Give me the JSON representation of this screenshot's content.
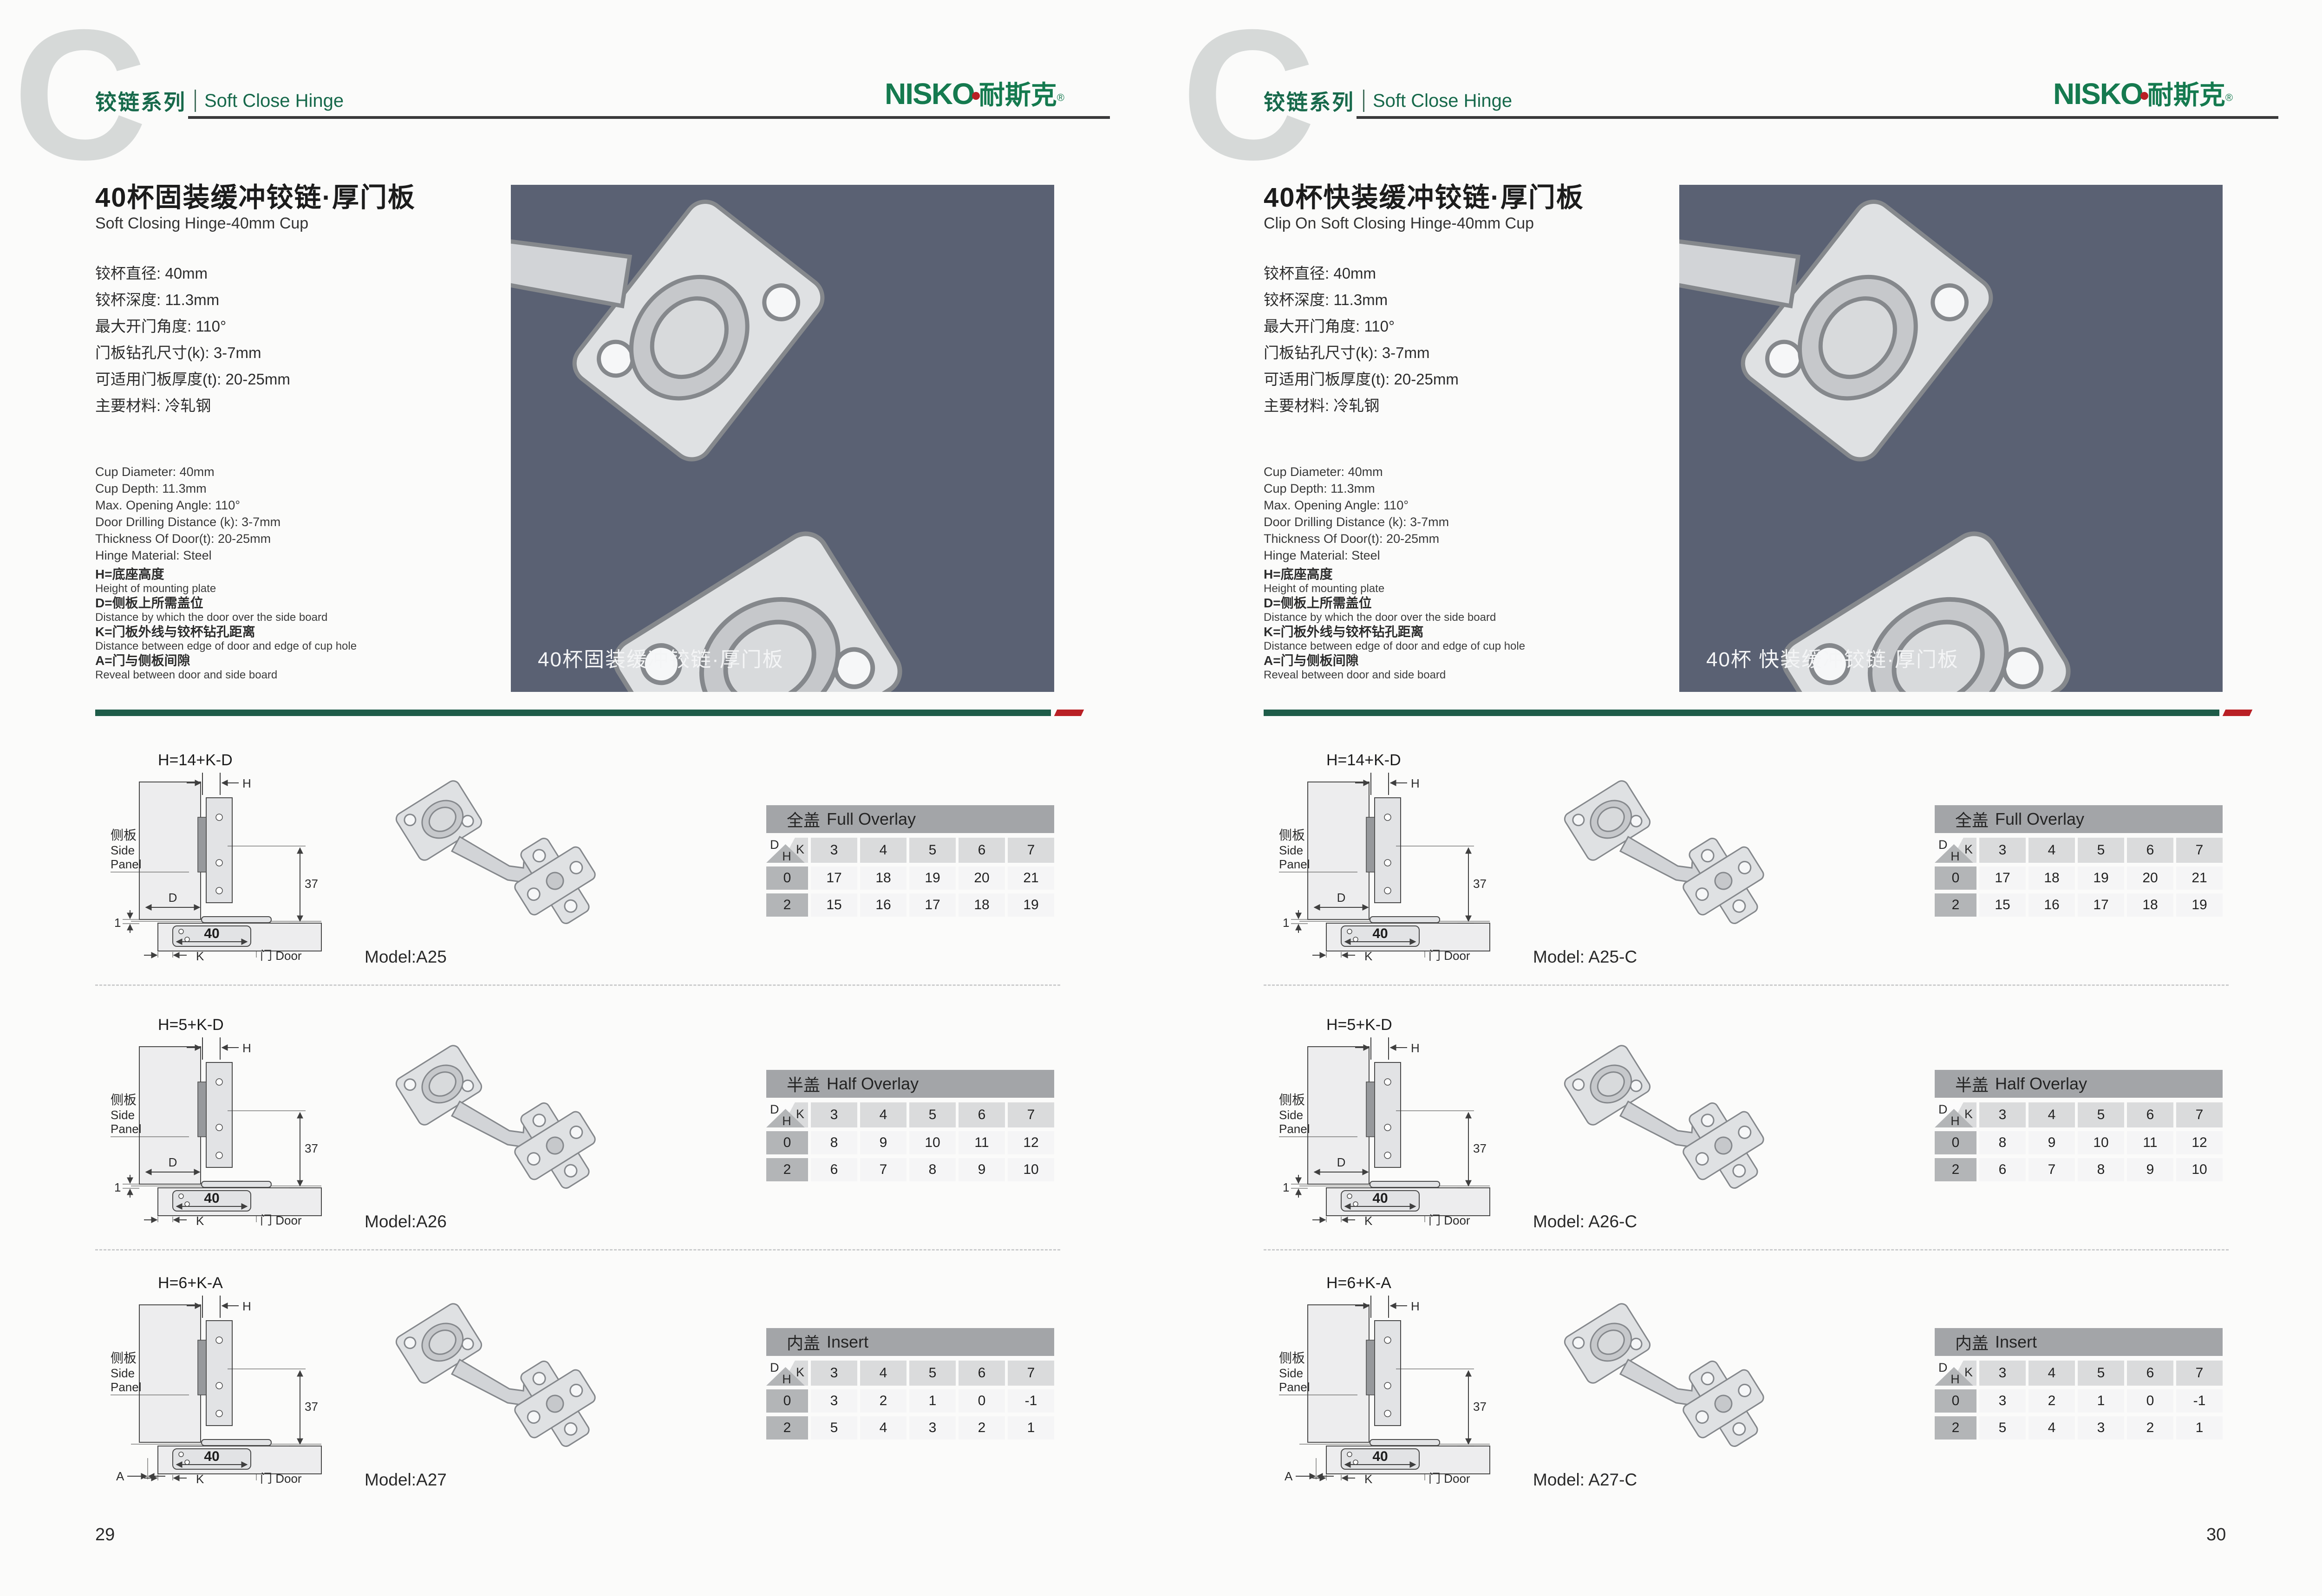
{
  "colors": {
    "accent_green": "#17694b",
    "logo_green": "#157a4f",
    "accent_red": "#b92025",
    "photo_bg": "#5a6173",
    "table_title_bg": "#a3a5a8",
    "column_header_bg": "#dadbdc",
    "row_header_bg": "#b3b5b7",
    "cell_bg": "#f5f5f6",
    "header_rule": "#3a3a3b",
    "divider_green": "#1e5c49"
  },
  "header": {
    "c_mark": "C",
    "series_cn": "铰链系列",
    "series_en": "Soft Close Hinge"
  },
  "brand": {
    "en": "NISKO",
    "cn": "耐斯克",
    "reg": "®"
  },
  "shared": {
    "specs_cn": [
      "铰杯直径: 40mm",
      "铰杯深度: 11.3mm",
      "最大开门角度: 110°",
      "门板钻孔尺寸(k): 3-7mm",
      "可适用门板厚度(t): 20-25mm",
      "主要材料: 冷轧钢"
    ],
    "specs_en": [
      "Cup Diameter: 40mm",
      "Cup Depth: 11.3mm",
      "Max. Opening Angle: 110°",
      "Door Drilling Distance (k): 3-7mm",
      "Thickness Of Door(t): 20-25mm",
      "Hinge Material: Steel"
    ],
    "legend": [
      {
        "cn": "H=底座高度",
        "en": "Height of mounting plate"
      },
      {
        "cn": "D=侧板上所需盖位",
        "en": "Distance by which the door over the side board"
      },
      {
        "cn": "K=门板外线与铰杯钻孔距离",
        "en": "Distance between edge of door and edge of cup hole"
      },
      {
        "cn": "A=门与侧板间隙",
        "en": "Reveal between door and side board"
      }
    ]
  },
  "diagram": {
    "h": "H",
    "k": "K",
    "d": "D",
    "a": "A",
    "one": "1",
    "d37": "37",
    "d40": "40",
    "side_cn": "侧板",
    "side_en1": "Side",
    "side_en2": "Panel",
    "door": "门 Door"
  },
  "pages": [
    {
      "page_number": "29",
      "title_cn": "40杯固装缓冲铰链·厚门板",
      "title_en": "Soft Closing Hinge-40mm Cup",
      "photo_caption": "40杯固装缓冲铰链·厚门板",
      "rows": [
        {
          "model": "Model:A25",
          "formula": "H=14+K-D",
          "diagram_type": "overlay",
          "table": {
            "title_cn": "全盖",
            "title_en": "Full Overlay",
            "corner": {
              "d": "D",
              "k": "K",
              "h": "H"
            },
            "columns": [
              "3",
              "4",
              "5",
              "6",
              "7"
            ],
            "rows": [
              {
                "header": "0",
                "values": [
                  "17",
                  "18",
                  "19",
                  "20",
                  "21"
                ]
              },
              {
                "header": "2",
                "values": [
                  "15",
                  "16",
                  "17",
                  "18",
                  "19"
                ]
              }
            ]
          }
        },
        {
          "model": "Model:A26",
          "formula": "H=5+K-D",
          "diagram_type": "overlay",
          "table": {
            "title_cn": "半盖",
            "title_en": "Half Overlay",
            "corner": {
              "d": "D",
              "k": "K",
              "h": "H"
            },
            "columns": [
              "3",
              "4",
              "5",
              "6",
              "7"
            ],
            "rows": [
              {
                "header": "0",
                "values": [
                  "8",
                  "9",
                  "10",
                  "11",
                  "12"
                ]
              },
              {
                "header": "2",
                "values": [
                  "6",
                  "7",
                  "8",
                  "9",
                  "10"
                ]
              }
            ]
          }
        },
        {
          "model": "Model:A27",
          "formula": "H=6+K-A",
          "diagram_type": "insert",
          "table": {
            "title_cn": "内盖",
            "title_en": "Insert",
            "corner": {
              "d": "D",
              "k": "K",
              "h": "H"
            },
            "columns": [
              "3",
              "4",
              "5",
              "6",
              "7"
            ],
            "rows": [
              {
                "header": "0",
                "values": [
                  "3",
                  "2",
                  "1",
                  "0",
                  "-1"
                ]
              },
              {
                "header": "2",
                "values": [
                  "5",
                  "4",
                  "3",
                  "2",
                  "1"
                ]
              }
            ]
          }
        }
      ]
    },
    {
      "page_number": "30",
      "title_cn": "40杯快装缓冲铰链·厚门板",
      "title_en": "Clip On Soft Closing Hinge-40mm Cup",
      "photo_caption": "40杯 快装缓冲铰链·厚门板",
      "rows": [
        {
          "model": "Model: A25-C",
          "formula": "H=14+K-D",
          "diagram_type": "overlay",
          "table": {
            "title_cn": "全盖",
            "title_en": "Full Overlay",
            "corner": {
              "d": "D",
              "k": "K",
              "h": "H"
            },
            "columns": [
              "3",
              "4",
              "5",
              "6",
              "7"
            ],
            "rows": [
              {
                "header": "0",
                "values": [
                  "17",
                  "18",
                  "19",
                  "20",
                  "21"
                ]
              },
              {
                "header": "2",
                "values": [
                  "15",
                  "16",
                  "17",
                  "18",
                  "19"
                ]
              }
            ]
          }
        },
        {
          "model": "Model: A26-C",
          "formula": "H=5+K-D",
          "diagram_type": "overlay",
          "table": {
            "title_cn": "半盖",
            "title_en": "Half Overlay",
            "corner": {
              "d": "D",
              "k": "K",
              "h": "H"
            },
            "columns": [
              "3",
              "4",
              "5",
              "6",
              "7"
            ],
            "rows": [
              {
                "header": "0",
                "values": [
                  "8",
                  "9",
                  "10",
                  "11",
                  "12"
                ]
              },
              {
                "header": "2",
                "values": [
                  "6",
                  "7",
                  "8",
                  "9",
                  "10"
                ]
              }
            ]
          }
        },
        {
          "model": "Model: A27-C",
          "formula": "H=6+K-A",
          "diagram_type": "insert",
          "table": {
            "title_cn": "内盖",
            "title_en": "Insert",
            "corner": {
              "d": "D",
              "k": "K",
              "h": "H"
            },
            "columns": [
              "3",
              "4",
              "5",
              "6",
              "7"
            ],
            "rows": [
              {
                "header": "0",
                "values": [
                  "3",
                  "2",
                  "1",
                  "0",
                  "-1"
                ]
              },
              {
                "header": "2",
                "values": [
                  "5",
                  "4",
                  "3",
                  "2",
                  "1"
                ]
              }
            ]
          }
        }
      ]
    }
  ]
}
